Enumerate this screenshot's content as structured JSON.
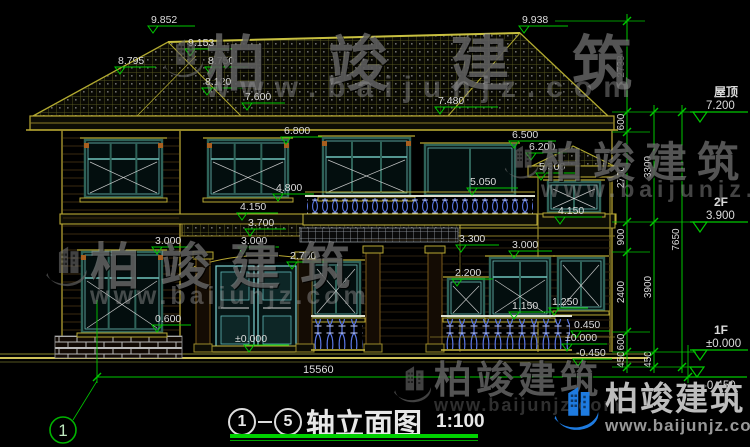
{
  "title_block": {
    "axis_start": "1",
    "axis_end": "5",
    "name": "轴立面图",
    "scale": "1:100"
  },
  "axis_bubble_label": "1",
  "bottom_dimension": "15560",
  "watermark": {
    "brand": "柏竣建筑",
    "url": "www.baijunjz.com"
  },
  "levels_right": [
    {
      "name": "屋顶",
      "value": "7.200",
      "tx": 700,
      "ty": 122,
      "len": 48
    },
    {
      "name": "2F",
      "value": "3.900",
      "tx": 700,
      "ty": 232,
      "len": 48
    },
    {
      "name": "1F",
      "value": "±0.000",
      "tx": 700,
      "ty": 360,
      "len": 48
    },
    {
      "name": "",
      "value": "-0.450",
      "tx": 697,
      "ty": 377,
      "len": 50,
      "below": true
    }
  ],
  "elevation_markers": [
    {
      "label": "9.852",
      "tx": 153,
      "ty": 33,
      "len": 42
    },
    {
      "label": "9.938",
      "tx": 524,
      "ty": 33,
      "len": 44
    },
    {
      "label": "9.153",
      "tx": 190,
      "ty": 56,
      "len": 42
    },
    {
      "label": "8.750",
      "tx": 210,
      "ty": 74,
      "len": 38
    },
    {
      "label": "8.120",
      "tx": 207,
      "ty": 95,
      "len": 36
    },
    {
      "label": "7.600",
      "tx": 247,
      "ty": 110,
      "len": 38
    },
    {
      "label": "8.795",
      "tx": 120,
      "ty": 74,
      "len": 36
    },
    {
      "label": "7.480",
      "tx": 440,
      "ty": 114,
      "len": 58
    },
    {
      "label": "6.800",
      "tx": 286,
      "ty": 144,
      "len": 36
    },
    {
      "label": "6.500",
      "tx": 514,
      "ty": 148,
      "len": 42
    },
    {
      "label": "6.200",
      "tx": 531,
      "ty": 160,
      "len": 36
    },
    {
      "label": "5.300",
      "tx": 541,
      "ty": 180,
      "len": 34
    },
    {
      "label": "5.050",
      "tx": 472,
      "ty": 195,
      "len": 46
    },
    {
      "label": "4.800",
      "tx": 278,
      "ty": 201,
      "len": 36
    },
    {
      "label": "4.150",
      "tx": 560,
      "ty": 224,
      "len": 42
    },
    {
      "label": "4.150",
      "tx": 242,
      "ty": 220,
      "len": 36
    },
    {
      "label": "3.700",
      "tx": 250,
      "ty": 236,
      "len": 36
    },
    {
      "label": "3.000",
      "tx": 157,
      "ty": 254,
      "len": 36
    },
    {
      "label": "3.000",
      "tx": 243,
      "ty": 254,
      "len": 36
    },
    {
      "label": "2.700",
      "tx": 292,
      "ty": 269,
      "len": 36
    },
    {
      "label": "3.300",
      "tx": 461,
      "ty": 252,
      "len": 38
    },
    {
      "label": "3.000",
      "tx": 514,
      "ty": 258,
      "len": 38
    },
    {
      "label": "2.200",
      "tx": 457,
      "ty": 286,
      "len": 36
    },
    {
      "label": "1.150",
      "tx": 514,
      "ty": 319,
      "len": 36
    },
    {
      "label": "1.250",
      "tx": 554,
      "ty": 315,
      "len": 34
    },
    {
      "label": "0.600",
      "tx": 157,
      "ty": 332,
      "len": 34
    },
    {
      "label": "±0.000",
      "tx": 249,
      "ty": 352,
      "len": 40,
      "tdx": -14
    },
    {
      "label": "0.450",
      "tx": 576,
      "ty": 338,
      "len": 34
    },
    {
      "label": "±0.000",
      "tx": 567,
      "ty": 351,
      "len": 40
    },
    {
      "label": "-0.450",
      "tx": 578,
      "ty": 366,
      "len": 34
    }
  ],
  "vertical_dimensions": [
    {
      "label": "2738",
      "x": 627,
      "y1": 21,
      "y2": 112
    },
    {
      "label": "600",
      "x": 627,
      "y1": 112,
      "y2": 132
    },
    {
      "label": "2700",
      "x": 627,
      "y1": 132,
      "y2": 222
    },
    {
      "label": "900",
      "x": 627,
      "y1": 222,
      "y2": 252
    },
    {
      "label": "2400",
      "x": 627,
      "y1": 252,
      "y2": 332
    },
    {
      "label": "600",
      "x": 627,
      "y1": 332,
      "y2": 352
    },
    {
      "label": "450",
      "x": 627,
      "y1": 352,
      "y2": 367
    },
    {
      "label": "3300",
      "x": 654,
      "y1": 112,
      "y2": 222
    },
    {
      "label": "3900",
      "x": 654,
      "y1": 222,
      "y2": 352
    },
    {
      "label": "450",
      "x": 654,
      "y1": 352,
      "y2": 367
    },
    {
      "label": "7650",
      "x": 682,
      "y1": 112,
      "y2": 367
    }
  ],
  "colors": {
    "dim_green": "#00c800",
    "dim_text": "#dcdcdc",
    "cad_yellow": "#b8a832",
    "window_teal": "#2e6258",
    "window_cyan": "#6fc4bc",
    "baluster_blue": "#5b79e8",
    "brand_blue": "#1e7be0"
  }
}
